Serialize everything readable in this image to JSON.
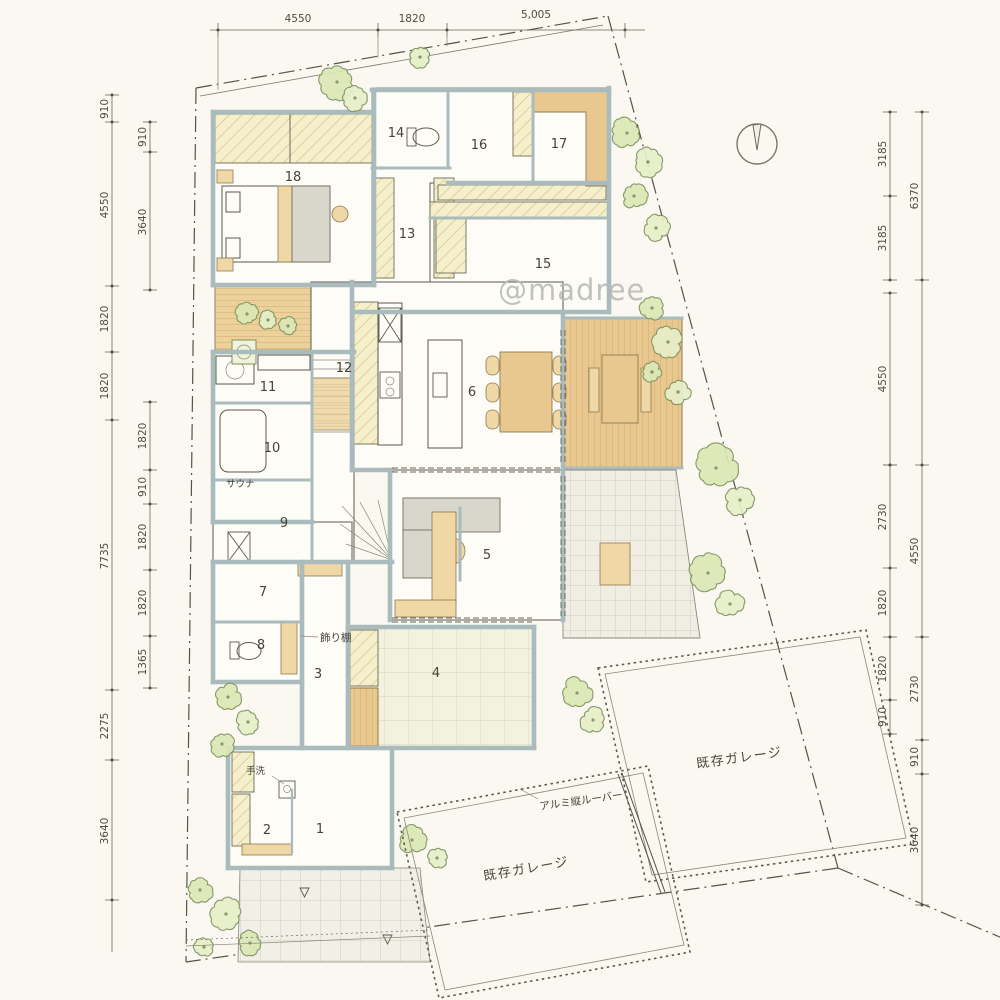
{
  "watermark": "@madree",
  "dimensions": {
    "top": [
      "4550",
      "1820",
      "5,005"
    ],
    "left_outer": [
      "910",
      "4550",
      "1820",
      "1820",
      "7735",
      "2275",
      "3640"
    ],
    "left_inner_upper": [
      "910",
      "3640"
    ],
    "left_inner_lower": [
      "1820",
      "910",
      "1820",
      "1820",
      "1365"
    ],
    "right_inner_upper": [
      "3185",
      "3185"
    ],
    "right_inner_mid": [
      "4550"
    ],
    "right_inner_lower": [
      "2730",
      "1820",
      "1820",
      "910"
    ],
    "right_outer_upper": [
      "6370"
    ],
    "right_outer_lower": [
      "4550",
      "2730",
      "910",
      "3640"
    ]
  },
  "rooms": [
    "1",
    "2",
    "3",
    "4",
    "5",
    "6",
    "7",
    "8",
    "9",
    "10",
    "11",
    "12",
    "13",
    "14",
    "15",
    "16",
    "17",
    "18"
  ],
  "labels": {
    "sauna": "サウナ",
    "display_shelf": "飾り棚",
    "hand_wash": "手洗",
    "aluminum_louver": "アルミ縦ルーバー",
    "existing_garage_right": "既存ガレージ",
    "existing_garage_bottom": "既存ガレージ"
  }
}
